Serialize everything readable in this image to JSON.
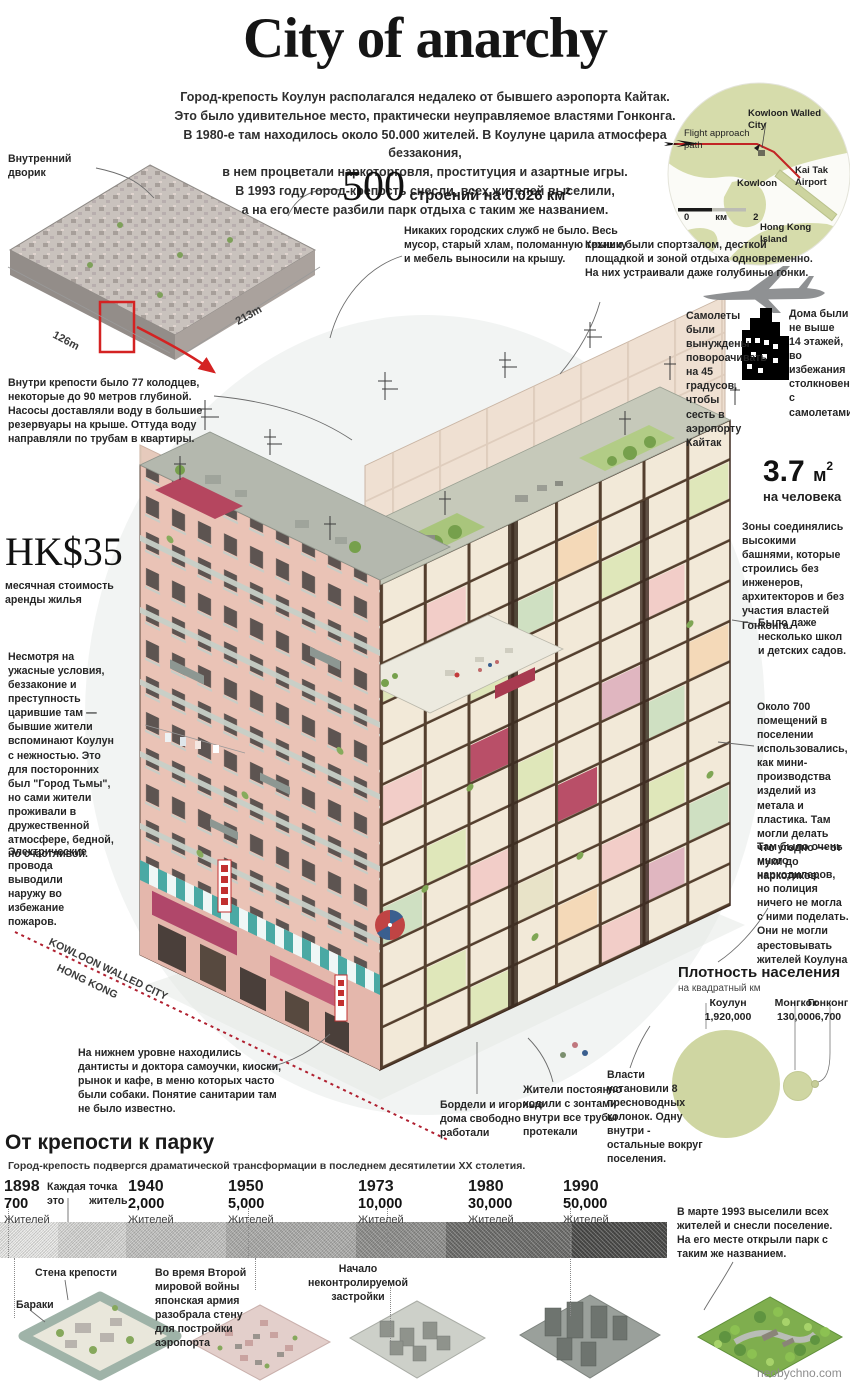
{
  "title": "City of anarchy",
  "intro": {
    "lines": [
      "Город-крепость Коулун располагался недалеко от бывшего аэропорта Кайтак.",
      "Это было удивительное место, практически  неуправляемое властями Гонконга.",
      "В 1980-е там находилось  около 50.000 жителей. В Коулуне царила атмосфера беззакония,",
      "в нем процветали наркоторговля, проституция и  азартные игры.",
      "В 1993 году город-крепость снесли, всех жителей выселили,",
      "а на его месте  разбили парк отдыха с таким же названием."
    ]
  },
  "map": {
    "flight": "Flight approach path",
    "city": "Kowloon Walled City",
    "kowloon": "Kowloon",
    "airport": "Kai Tak Airport",
    "island": "Hong Kong Island",
    "scale": {
      "zero": "0",
      "unit": "км",
      "max": "2"
    }
  },
  "stats": {
    "buildings": {
      "number": "500",
      "caption": "строений на 0.026 км",
      "sup": "2"
    },
    "rent": {
      "number": "HK$35",
      "caption": "месячная стоимость аренды жилья"
    },
    "area": {
      "number": "3.7",
      "unit": "м",
      "sup": "2",
      "caption": "на человека"
    }
  },
  "overview": {
    "courtyard": "Внутренний дворик",
    "width": "126m",
    "depth": "213m"
  },
  "annotations": {
    "wells": "Внутри крепости было 77 колодцев, некоторые до 90 метров глубиной. Насосы доставляли воду в большие резервуары на крыше. Оттуда воду направляли по трубам в  квартиры.",
    "no_services": "Никаких городских служб не было. Весь мусор, старый хлам, поломанную технику и мебель выносили на крышу.",
    "roofs": "Крыши были спортзалом, десткой площадкой и зоной отдыха одновременно. На них устраивали даже голубиные гонки.",
    "planes": "Самолеты были вынуждены повороачивать на 45 градусов, чтобы сесть в аэропорту Кайтак",
    "houses": "Дома были не выше 14 этажей, во избежания столкновения с самолетами.",
    "towers": "Зоны соединялись высокими башнями, которые строились без инженеров, архитекторов и без участия властей Гонконга.",
    "schools": "Было даже несколько школ и детских  садов.",
    "workshops": "Около 700 помещений в поселении использовались, как мини-производства изделий из метала и пластика. Там могли делать что угодно — от муки до наркотиков.",
    "dealers": "Там было очень много наркодилеров,  но полиция ничего не могла с ними поделать. Они не могли арестовывать жителей Коулуна",
    "despite": "Несмотря на ужасные условия, беззаконие и преступность царившие там — бывшие жители вспоминают Коулун с нежностью.  Это для посторонних был \"Город Тьмы\", но сами жители проживали в дружественной атмосфере, бедной, но счастливой.",
    "wires": "Электрические провода выводили наружу во избежание пожаров.",
    "ground": "На нижнем уровне находились дантисты и доктора самоучки, киоски, рынок и кафе, в меню которых часто были собаки. Понятие санитарии там не было известно.",
    "brothels": "Бордели и игорные дома  свободно работали",
    "umbrellas": "Жители постоянно ходили с зонтами внутри все трубы протекали",
    "pumps": "Власти установили 8 пресноводных колонок. Одну внутри - остальные вокруг поселения."
  },
  "boundary": {
    "line1": "KOWLOON WALLED CITY",
    "line2": "HONG KONG"
  },
  "density": {
    "title": "Плотность населения",
    "subtitle": "на квадратный км",
    "items": [
      {
        "name": "Коулун",
        "value": "1,920,000"
      },
      {
        "name": "Монгкок",
        "value": "130,000"
      },
      {
        "name": "Гонконг",
        "value": "6,700"
      }
    ]
  },
  "timeline": {
    "header": "От крепости к парку",
    "subheader": "Город-крепость подвергся драматической трансформации в последнем десятилетии XX столетия.",
    "legend": {
      "line1": "Каждая точка",
      "line2": "это житель"
    },
    "entries": [
      {
        "year": "1898",
        "pop": "700",
        "unit": "Жителей"
      },
      {
        "year": "1940",
        "pop": "2,000",
        "unit": "Жителей"
      },
      {
        "year": "1950",
        "pop": "5,000",
        "unit": "Жителей"
      },
      {
        "year": "1973",
        "pop": "10,000",
        "unit": "Жителей"
      },
      {
        "year": "1980",
        "pop": "30,000",
        "unit": "Жителей"
      },
      {
        "year": "1990",
        "pop": "50,000",
        "unit": "Жителей"
      }
    ],
    "note": "В марте  1993 выселили  всех жителей и снесли поселение. На его месте открыли парк с таким же названием."
  },
  "stages": {
    "wall": "Стена крепости",
    "barracks": "Бараки",
    "ww2": "Во время Второй мировой войны японская армия разобрала стену для постройки аэропорта",
    "uncontrolled": "Начало неконтролируемой застройки"
  },
  "watermark": "neobychno.com",
  "colors": {
    "accent_red": "#c0392b",
    "map_land": "#d6dcab",
    "bubble": "#cfd6a2"
  },
  "chart_data": [
    {
      "type": "pie",
      "title": "Плотность населения",
      "subtitle": "на квадратный км",
      "categories": [
        "Коулун",
        "Монгкок",
        "Гонконг"
      ],
      "values": [
        1920000,
        130000,
        6700
      ],
      "legend_position": "top",
      "note": "bubble-area comparison of population density per square km"
    },
    {
      "type": "bar",
      "title": "От крепости к парку",
      "categories": [
        "1898",
        "1940",
        "1950",
        "1973",
        "1980",
        "1990"
      ],
      "values": [
        700,
        2000,
        5000,
        10000,
        30000,
        50000
      ],
      "xlabel": "год",
      "ylabel": "Жителей",
      "note": "dot-density strip; каждая точка — это житель; март 1993 — снос поселения"
    }
  ]
}
